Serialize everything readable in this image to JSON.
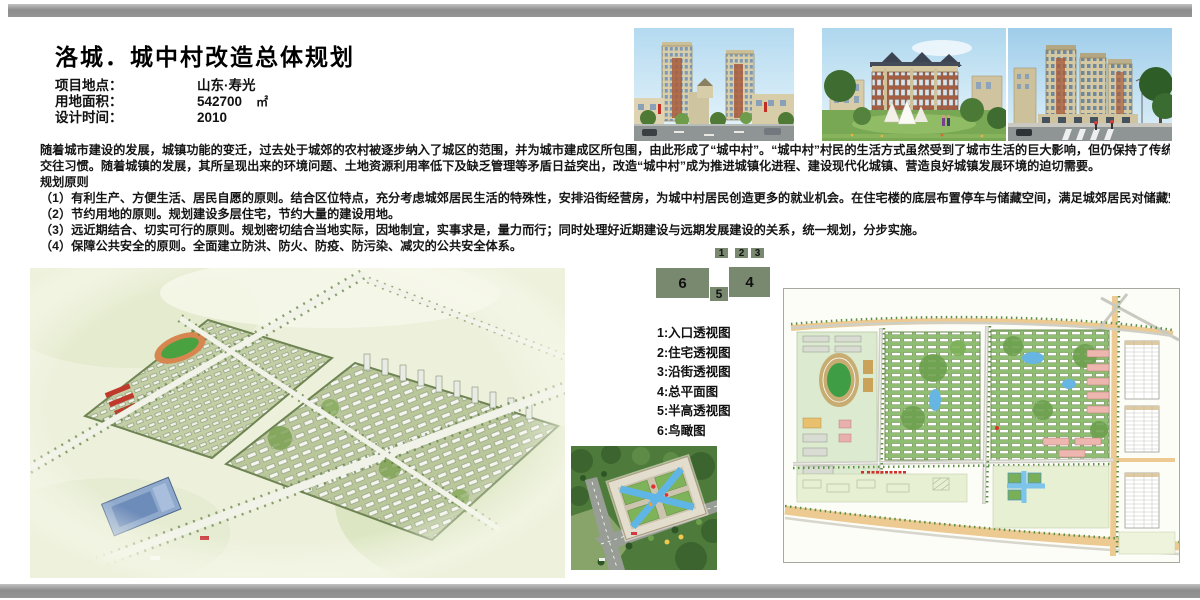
{
  "header": {
    "title": "洛城．城中村改造总体规划",
    "info": [
      {
        "label": "项目地点：",
        "value": "山东·寿光"
      },
      {
        "label": "用地面积：",
        "value": "542700",
        "unit": "㎡"
      },
      {
        "label": "设计时间：",
        "value": "2010"
      }
    ]
  },
  "description": {
    "lines": [
      "随着城市建设的发展，城镇功能的变迁，过去处于城郊的农村被逐步纳入了城区的范围，并为城市建成区所包围，由此形成了“城中村”。“城中村”村民的生活方式虽然受到了城市生活的巨大影响，但仍保持了传统的生活和",
      "交往习惯。随着城镇的发展，其所呈现出来的环境问题、土地资源利用率低下及缺乏管理等矛盾日益突出，改造“城中村”成为推进城镇化进程、建设现代化城镇、营造良好城镇发展环境的迫切需要。"
    ],
    "principles_title": "规划原则",
    "principles": [
      "（1）有利生产、方便生活、居民自愿的原则。结合区位特点，充分考虑城郊居民生活的特殊性，安排沿街经营房，为城中村居民创造更多的就业机会。在住宅楼的底层布置停车与储藏空间，满足城郊居民对储藏空间的需要。",
      "（2）节约用地的原则。规划建设多层住宅，节约大量的建设用地。",
      "（3）远近期结合、切实可行的原则。规划密切结合当地实际，因地制宜，实事求是，量力而行；同时处理好近期建设与远期发展建设的关系，统一规划，分步实施。",
      "（4）保障公共安全的原则。全面建立防洪、防火、防疫、防污染、减灾的公共安全体系。"
    ]
  },
  "key_map": {
    "color": "#78896f",
    "blocks": [
      {
        "num": "1"
      },
      {
        "num": "2"
      },
      {
        "num": "3"
      },
      {
        "num": "4"
      },
      {
        "num": "5"
      },
      {
        "num": "6"
      }
    ]
  },
  "legend": {
    "items": [
      "1:入口透视图",
      "2:住宅透视图",
      "3:沿街透视图",
      "4:总平面图",
      "5:半高透视图",
      "6:鸟瞰图"
    ]
  }
}
